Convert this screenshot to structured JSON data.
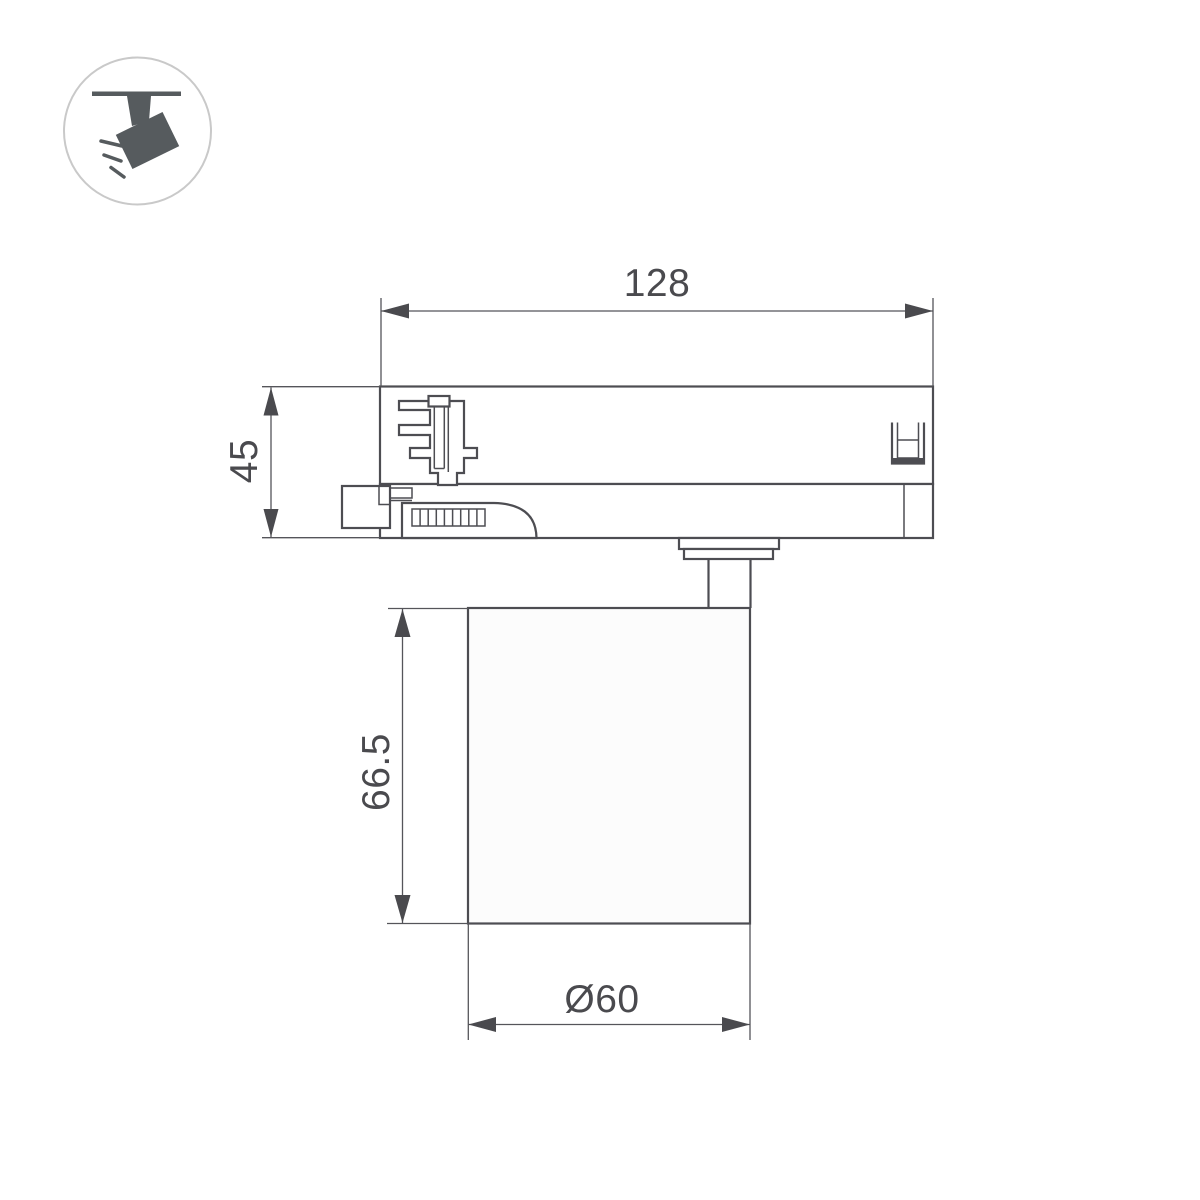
{
  "drawing": {
    "type": "technical-dimension-drawing",
    "subject": "track-mounted spotlight, side view",
    "dimensions": {
      "track_adapter_width": "128",
      "track_adapter_height": "45",
      "lamp_body_height": "66.5",
      "lamp_body_diameter": "Ø60"
    },
    "icon": {
      "name": "ceiling-track-spotlight-icon",
      "description": "circled pictogram of a spotlight hanging from a track emitting light rays"
    },
    "colors": {
      "background": "#ffffff",
      "object_line": "#4d4d52",
      "dimension_line": "#55555a",
      "dimension_text": "#4a4a4e",
      "icon_fill": "#565b5e",
      "icon_circle_stroke": "#c9c9c9",
      "lamp_body_fill": "#fcfcfc"
    }
  }
}
